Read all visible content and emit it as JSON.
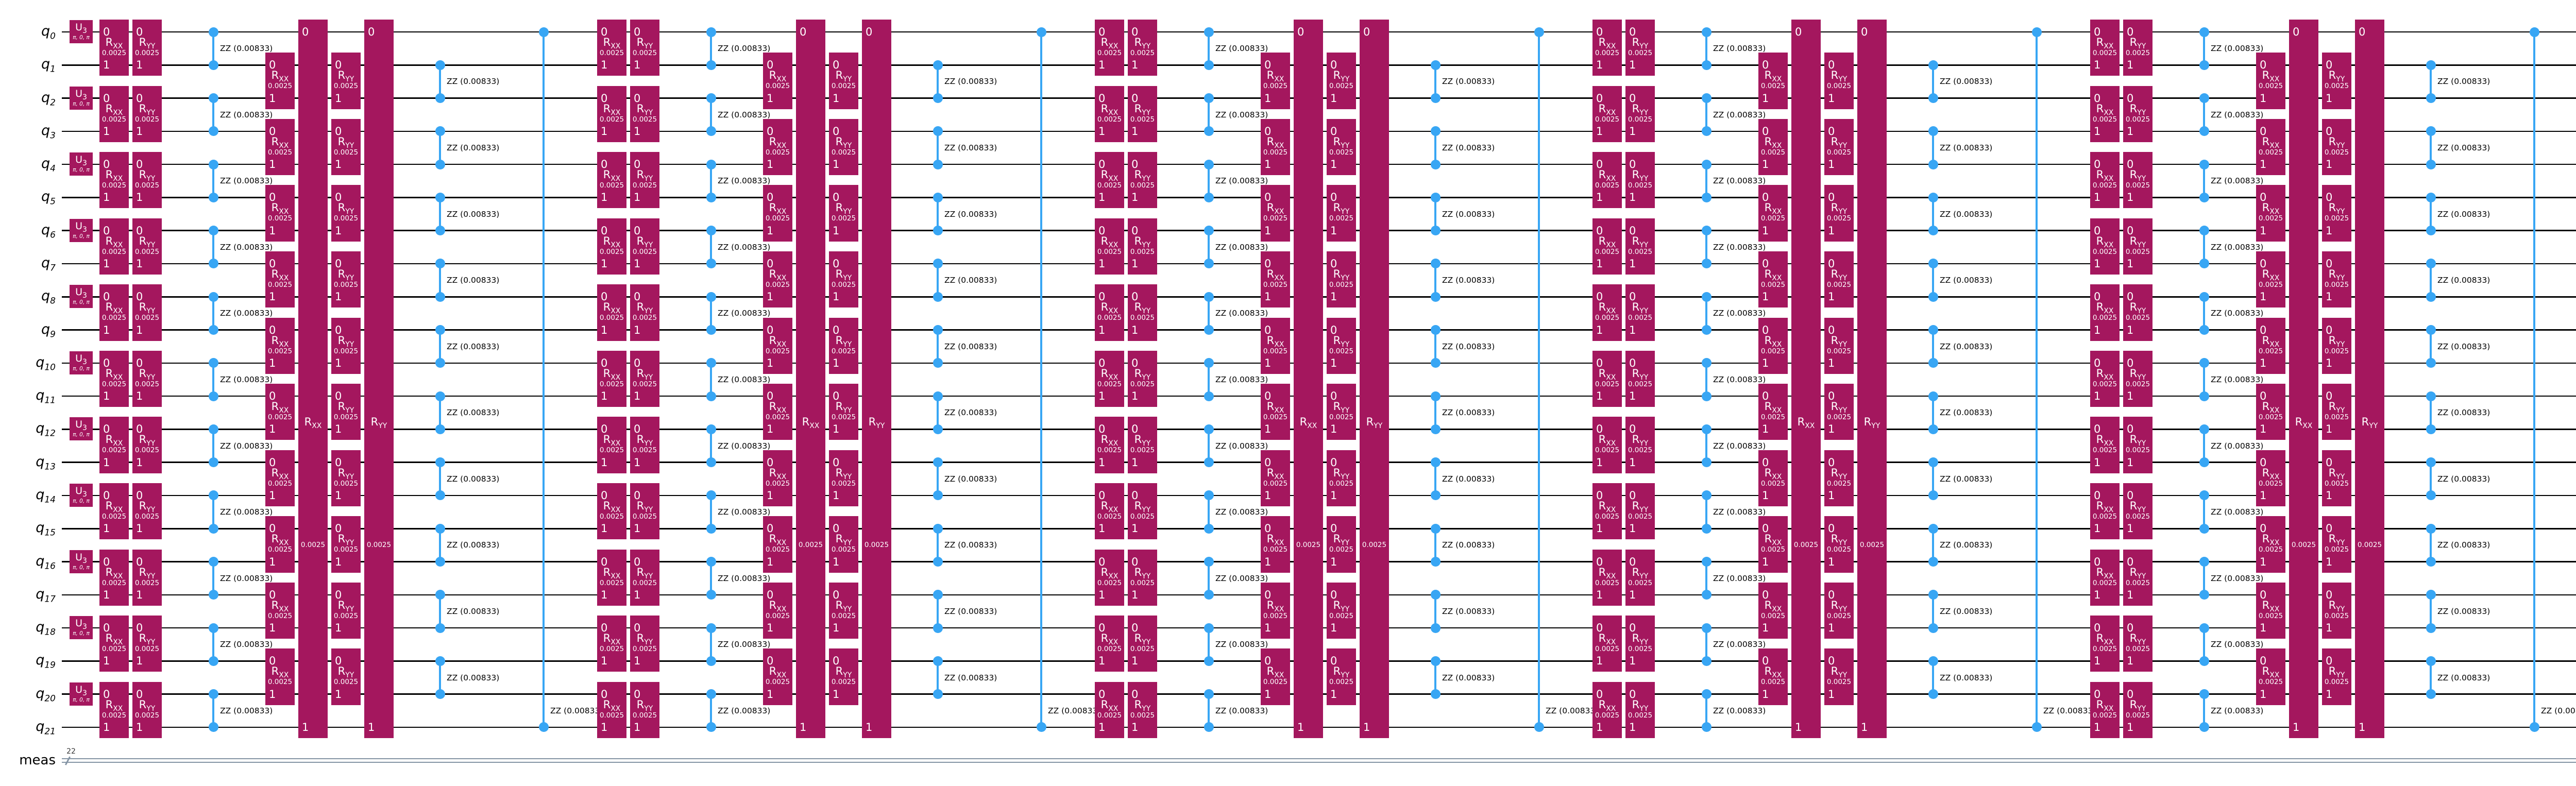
{
  "circuit": {
    "type": "quantum-circuit-diagram",
    "qubit_prefix": "q",
    "qubit_indices": [
      "0",
      "1",
      "2",
      "3",
      "4",
      "5",
      "6",
      "7",
      "8",
      "9",
      "10",
      "11",
      "12",
      "13",
      "14",
      "15",
      "16",
      "17",
      "18",
      "19",
      "20",
      "21"
    ],
    "num_qubits": 22,
    "classical_register": {
      "name": "meas",
      "size": "22",
      "bit_labels": [
        "0",
        "1",
        "2",
        "3",
        "4",
        "5",
        "6",
        "7",
        "8",
        "9",
        "10",
        "11",
        "12",
        "13",
        "14",
        "15",
        "16",
        "17",
        "18",
        "19",
        "20",
        "21"
      ]
    },
    "initial_layer": {
      "gate_label": "U",
      "gate_sub": "3",
      "params_label": "π, 0, π",
      "on_qubits": [
        0,
        2,
        4,
        6,
        8,
        10,
        12,
        14,
        16,
        18,
        20
      ]
    },
    "gates": {
      "rxx": {
        "label": "R",
        "sub": "XX",
        "param": "0.0025"
      },
      "ryy": {
        "label": "R",
        "sub": "YY",
        "param": "0.0025"
      },
      "rzz": {
        "label": "ZZ (0.00833)"
      }
    },
    "pair_port_labels": {
      "top": "0",
      "bottom": "1"
    },
    "trotter_layers": {
      "count": 6,
      "even_pairs": [
        [
          0,
          1
        ],
        [
          2,
          3
        ],
        [
          4,
          5
        ],
        [
          6,
          7
        ],
        [
          8,
          9
        ],
        [
          10,
          11
        ],
        [
          12,
          13
        ],
        [
          14,
          15
        ],
        [
          16,
          17
        ],
        [
          18,
          19
        ],
        [
          20,
          21
        ]
      ],
      "odd_pairs": [
        [
          1,
          2
        ],
        [
          3,
          4
        ],
        [
          5,
          6
        ],
        [
          7,
          8
        ],
        [
          9,
          10
        ],
        [
          11,
          12
        ],
        [
          13,
          14
        ],
        [
          15,
          16
        ],
        [
          17,
          18
        ],
        [
          19,
          20
        ]
      ],
      "wrap_pair": [
        0,
        21
      ],
      "column_order": [
        "rxx-even",
        "ryy-even",
        "zz-even",
        "rxx-odd",
        "rxx-wrap",
        "ryy-odd",
        "ryy-wrap",
        "zz-odd",
        "zz-wrap"
      ]
    },
    "measurements": {
      "on_qubits": [
        0,
        1,
        2,
        3,
        4,
        5,
        6,
        7,
        8,
        9,
        10,
        11,
        12,
        13,
        14,
        15,
        16,
        17,
        18,
        19,
        20,
        21
      ]
    },
    "colors": {
      "background": "#ffffff",
      "gate_fill": "#a4175e",
      "gate_text": "#ffffff",
      "coupler_blue": "#38a6f4",
      "wire": "#000000",
      "classical": "#8494a4",
      "measure_fill": "#a9a9a9",
      "measure_icon": "#000000",
      "barrier_fill": "rgba(195,195,195,0.55)",
      "barrier_dash": "#000000",
      "label_text": "#000000"
    }
  }
}
